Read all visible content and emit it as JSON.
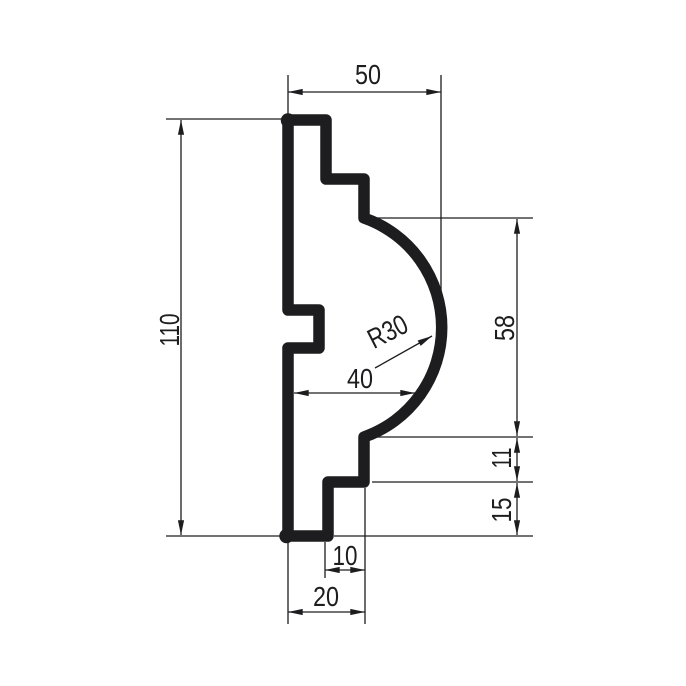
{
  "drawing": {
    "type": "technical-profile-section",
    "background_color": "#ffffff",
    "line_color": "#1d1d1f",
    "dimensions": {
      "width_top": "50",
      "height_overall": "110",
      "height_curve": "58",
      "radius": "R30",
      "width_mid": "40",
      "height_step_upper": "11",
      "height_step_lower": "15",
      "width_bottom_inner": "10",
      "width_bottom": "20"
    }
  }
}
